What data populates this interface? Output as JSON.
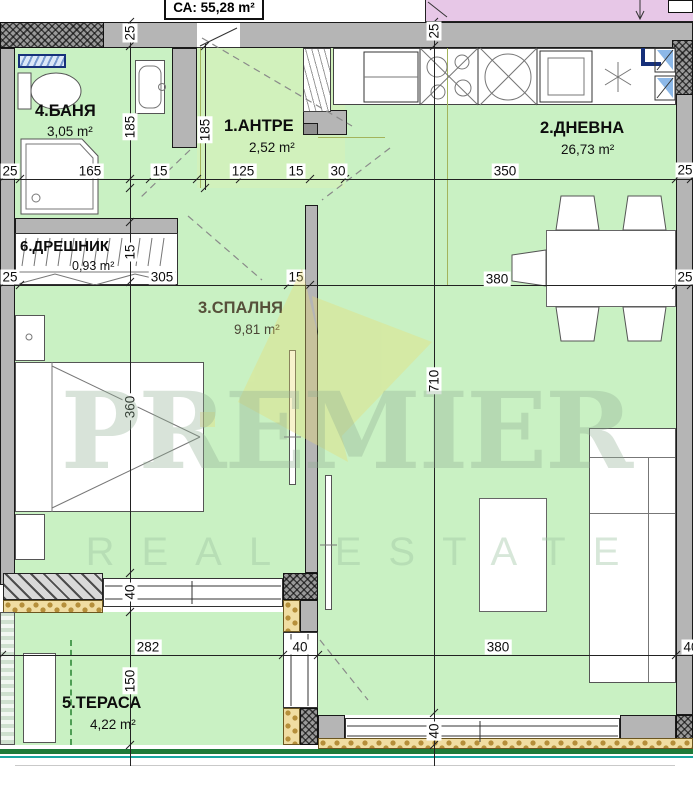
{
  "title_box": {
    "label": "СА: 55,28 m²"
  },
  "rooms": {
    "antre": {
      "name": "1.АНТРЕ",
      "area": "2,52 m²"
    },
    "dnevna": {
      "name": "2.ДНЕВНА",
      "area": "26,73 m²"
    },
    "spalnya": {
      "name": "3.СПАЛНЯ",
      "area": "9,81 m²"
    },
    "banya": {
      "name": "4.БАНЯ",
      "area": "3,05 m²"
    },
    "terasa": {
      "name": "5.ТЕРАСА",
      "area": "4,22 m²"
    },
    "dreshnik": {
      "name": "6.ДРЕШНИК",
      "area": "0,93 m²"
    }
  },
  "dimensions": {
    "chain_top": [
      "25",
      "165",
      "15",
      "125",
      "15",
      "30",
      "350",
      "25"
    ],
    "chain_middle": [
      "25",
      "305",
      "15",
      "380",
      "25"
    ],
    "chain_bottom": [
      "282",
      "40",
      "380",
      "40"
    ],
    "vertical_left": [
      "25",
      "185",
      "15",
      "360",
      "40",
      "150"
    ],
    "vertical_center": [
      "25",
      "710",
      "40"
    ],
    "vertical_antre": [
      "185"
    ]
  },
  "watermark": {
    "line1": "PREMIER",
    "line2": "REAL ESTATE"
  },
  "colors": {
    "floor_green": "#c9f1c3",
    "wall_gray": "#b5b5b5",
    "adjacent_pink": "#e7c7e7",
    "railing_green": "#1e7a38",
    "railing_teal": "#19a6a0",
    "insulation_yellow": "#f0dda2",
    "duct_blue": "#16307a"
  }
}
